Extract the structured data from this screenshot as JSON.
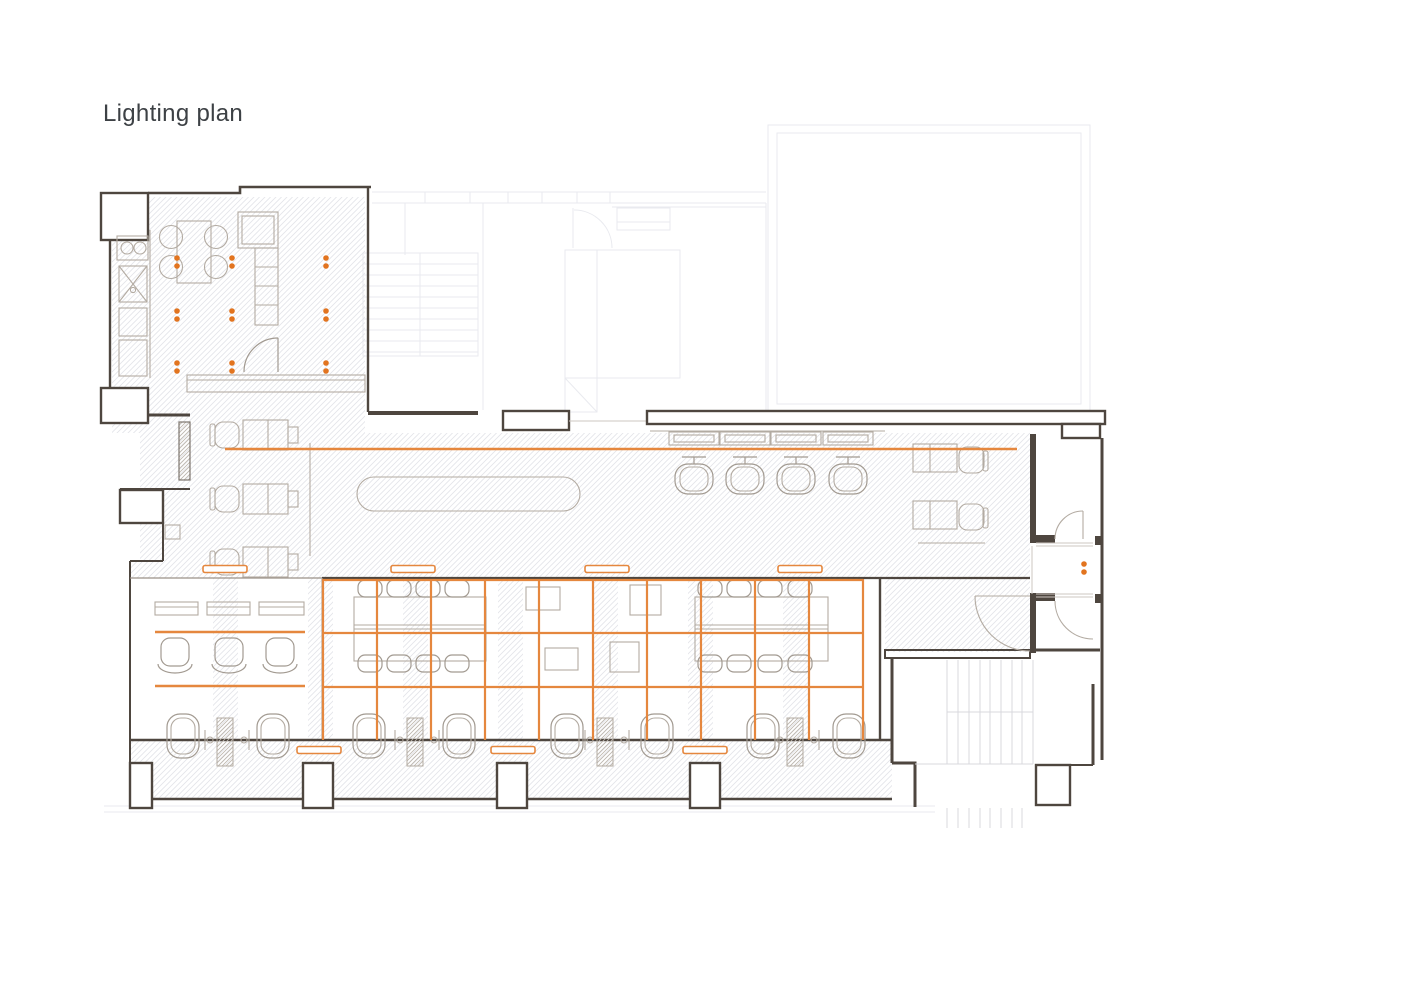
{
  "title": "Lighting plan",
  "colors": {
    "background": "#FFFFFF",
    "wall": "#4E463F",
    "furniture": "#B3ABA2",
    "hatch": "#E6E7EC",
    "faint": "#E9EAEF",
    "accent_orange": "#E5873E",
    "downlight_orange": "#E2741F"
  },
  "lighting": {
    "downlight_pairs": [
      {
        "x": 177,
        "y": 262
      },
      {
        "x": 232,
        "y": 262
      },
      {
        "x": 326,
        "y": 262
      },
      {
        "x": 177,
        "y": 315
      },
      {
        "x": 232,
        "y": 315
      },
      {
        "x": 326,
        "y": 315
      },
      {
        "x": 177,
        "y": 367
      },
      {
        "x": 232,
        "y": 367
      },
      {
        "x": 326,
        "y": 367
      },
      {
        "x": 1084,
        "y": 568
      }
    ],
    "tracks": [
      {
        "x1": 225,
        "y": 449,
        "x2": 1017
      },
      {
        "x1": 155,
        "y": 632,
        "x2": 305
      },
      {
        "x1": 155,
        "y": 686,
        "x2": 305
      }
    ],
    "linear_fixtures": [
      {
        "cx": 225,
        "cy": 569
      },
      {
        "cx": 413,
        "cy": 569
      },
      {
        "cx": 607,
        "cy": 569
      },
      {
        "cx": 800,
        "cy": 569
      },
      {
        "cx": 319,
        "cy": 750
      },
      {
        "cx": 513,
        "cy": 750
      },
      {
        "cx": 705,
        "cy": 750
      }
    ],
    "grid": {
      "x_start": 323,
      "x_end": 863,
      "y_top": 579,
      "y_bottom": 740,
      "spacing": 54,
      "row_lines_y": [
        580,
        633,
        687
      ]
    }
  }
}
